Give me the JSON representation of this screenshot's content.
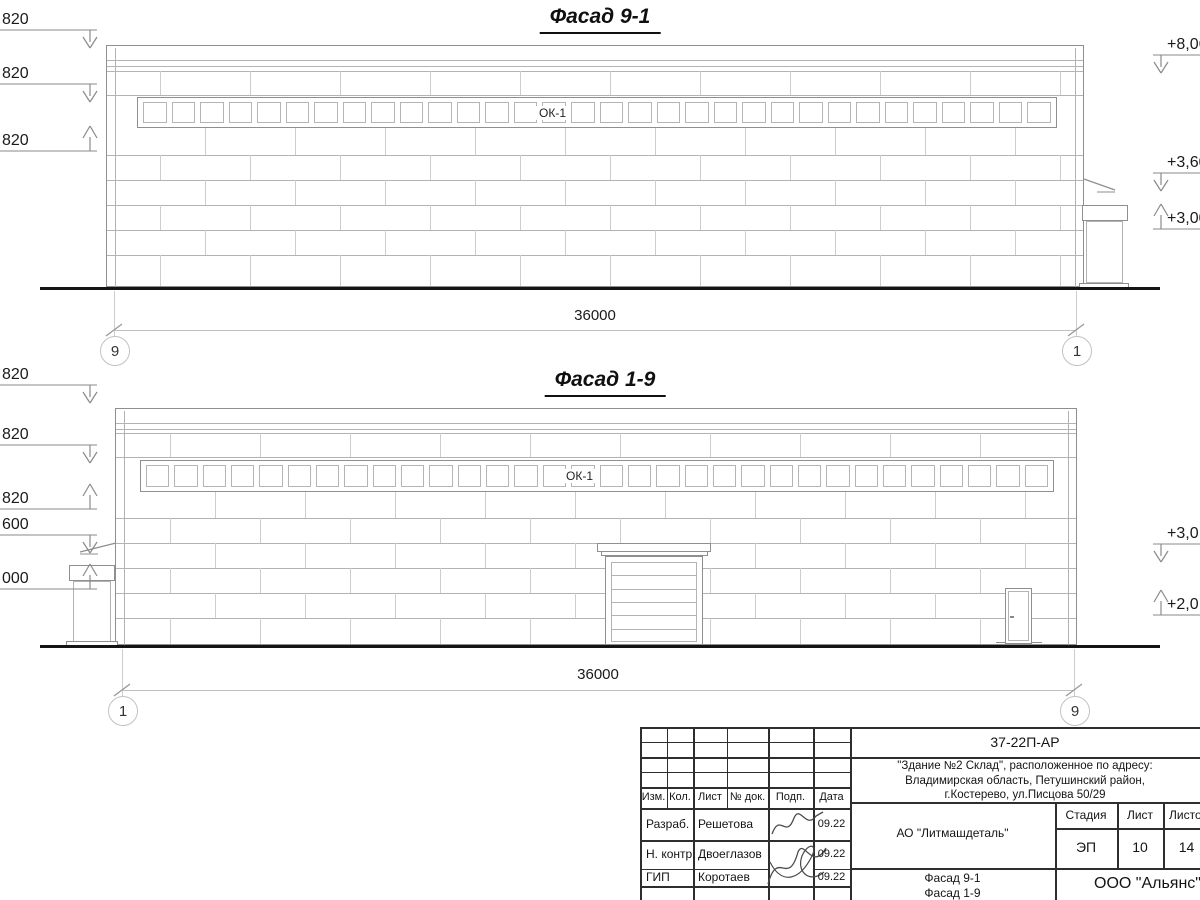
{
  "drawing": {
    "facades": [
      {
        "title": "Фасад 9-1",
        "window_band_label": "ОК-1",
        "window_count": 32,
        "dimension_label": "36000",
        "axis_left": "9",
        "axis_right": "1",
        "marks_left": [
          {
            "text": "820",
            "type": "down"
          },
          {
            "text": "820",
            "type": "down"
          },
          {
            "text": "820",
            "type": "up"
          }
        ],
        "marks_right": [
          {
            "text": "+8,06",
            "type": "down"
          },
          {
            "text": "+3,60",
            "type": "down"
          },
          {
            "text": "+3,00",
            "type": "up"
          }
        ]
      },
      {
        "title": "Фасад 1-9",
        "window_band_label": "ОК-1",
        "window_count": 32,
        "gate_slats": 6,
        "dimension_label": "36000",
        "axis_left": "1",
        "axis_right": "9",
        "marks_left": [
          {
            "text": "820",
            "type": "down"
          },
          {
            "text": "820",
            "type": "down"
          },
          {
            "text": "820",
            "type": "up"
          },
          {
            "text": "600",
            "type": "down"
          },
          {
            "text": "000",
            "type": "up"
          }
        ],
        "marks_right": [
          {
            "text": "+3,0",
            "type": "down"
          },
          {
            "text": "+2,0",
            "type": "up"
          }
        ]
      }
    ]
  },
  "title_block": {
    "doc_number": "37-22П-АР",
    "project_lines": [
      "\"Здание №2 Склад\", расположенное по адресу:",
      "Владимирская область, Петушинский район,",
      "г.Костерево, ул.Писцова 50/29"
    ],
    "cols": [
      "Изм.",
      "Кол.",
      "Лист",
      "№ док.",
      "Подп.",
      "Дата"
    ],
    "signers": [
      {
        "role": "Разраб.",
        "name": "Решетова",
        "date": "09.22"
      },
      {
        "role": "Н. контр.",
        "name": "Двоеглазов",
        "date": "09.22"
      },
      {
        "role": "ГИП",
        "name": "Коротаев",
        "date": "09.22"
      }
    ],
    "company": "АО \"Литмашдеталь\"",
    "stage_label": "Стадия",
    "sheet_label": "Лист",
    "sheets_label": "Листов",
    "stage": "ЭП",
    "sheet": "10",
    "sheets": "14",
    "sheet_title": [
      "Фасад 9-1",
      "Фасад 1-9"
    ],
    "org": "ООО \"Альянс\""
  },
  "colors": {
    "ground_line": "#141414",
    "outline": "#8f8f8f",
    "grid": "#b3b3b3",
    "joint": "#cdcdcd",
    "dim": "#c0c0c0",
    "mark": "#8a8a8a",
    "tblock": "#2e2e2e",
    "text": "#1a1a1a"
  }
}
